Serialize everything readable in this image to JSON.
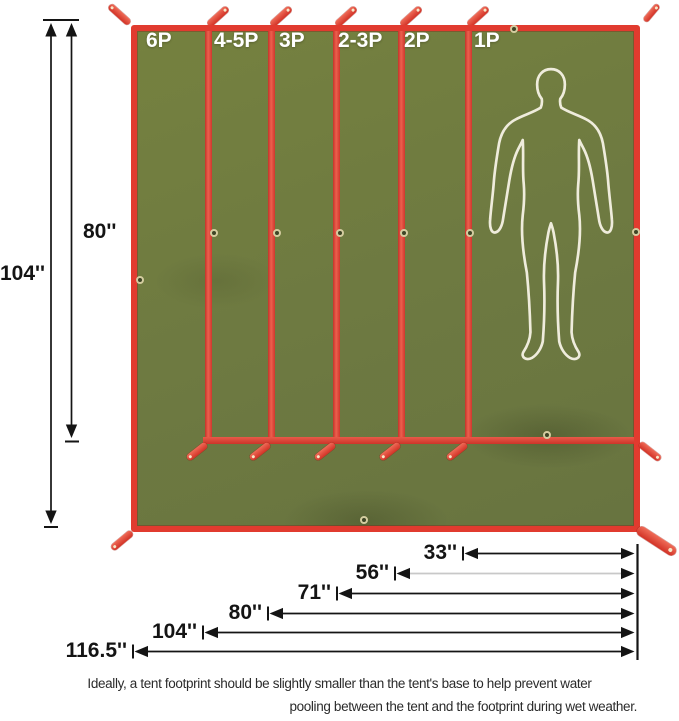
{
  "diagram": {
    "type": "tent-footprint-size-diagram",
    "sections": [
      {
        "label": "6P"
      },
      {
        "label": "4-5P"
      },
      {
        "label": "3P"
      },
      {
        "label": "2-3P"
      },
      {
        "label": "2P"
      },
      {
        "label": "1P"
      }
    ],
    "left_dims": [
      {
        "label": "104''"
      },
      {
        "label": "80''"
      }
    ],
    "bottom_dims": [
      {
        "label": "33''"
      },
      {
        "label": "56''"
      },
      {
        "label": "71''"
      },
      {
        "label": "80''"
      },
      {
        "label": "104''"
      },
      {
        "label": "116.5''"
      }
    ],
    "caption": {
      "line1": "Ideally, a tent footprint should be slightly smaller than the tent's base to help prevent water",
      "line2": "pooling between the tent and the footprint during wet weather."
    },
    "colors": {
      "tarp_green": "#6f7b42",
      "binding_red": "#e13b2f",
      "dim_line": "#141414",
      "dim_line_alt": "#c8c8c8",
      "silhouette": "#efecdc",
      "section_label_text": "#ffffff"
    },
    "icons": {
      "human_silhouette": "standing-person-outline",
      "grommet": "eyelet-ring",
      "strap": "tie-out-loop"
    }
  }
}
